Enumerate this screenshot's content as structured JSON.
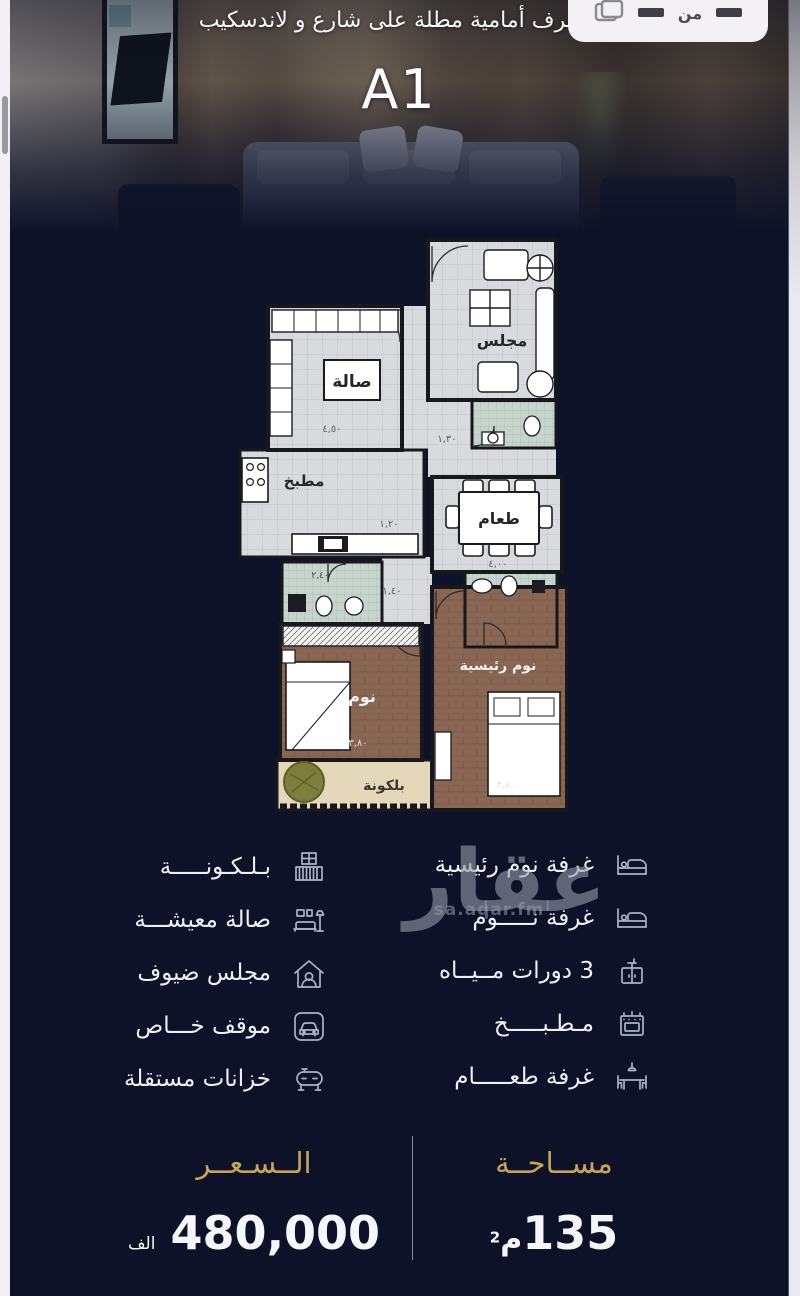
{
  "hero": {
    "title": "4 غرف أمامية مطلة على شارع و لاندسكيب",
    "unit_label": "A1",
    "badge_text": "من"
  },
  "floor_plan": {
    "rooms": {
      "majlis": "مجلس",
      "hall": "صالة",
      "kitchen": "مطبخ",
      "dining": "طعام",
      "bedroom": "نوم",
      "master_bedroom": "نوم رئيسية",
      "balcony": "بلكونة"
    },
    "dims": {
      "hall": "٤,٥٠",
      "dining": "٤,٠٠",
      "bedroom": "٣,٨٠",
      "master_bedroom": "٣,٨٠",
      "corridor_top": "١,٣٠",
      "corridor_kitchen": "١,٢٠",
      "corridor_lower": "١,٤٠",
      "bathroom": "٢,٤٠"
    }
  },
  "features": {
    "right": [
      {
        "icon": "bed-icon",
        "label": "غرفة نوم رئيسية"
      },
      {
        "icon": "bed-icon",
        "label": "غرفة نـــــوم"
      },
      {
        "icon": "sink-icon",
        "label": "3 دورات مــيــاه"
      },
      {
        "icon": "oven-icon",
        "label": "مـطـبـــــخ"
      },
      {
        "icon": "dining-table-icon",
        "label": "غرفة طعـــــام"
      }
    ],
    "left": [
      {
        "icon": "balcony-icon",
        "label": "بـلـكـونـــــة"
      },
      {
        "icon": "living-room-icon",
        "label": "صالة معيشـــة"
      },
      {
        "icon": "guest-majlis-icon",
        "label": "مجلس ضيوف"
      },
      {
        "icon": "car-icon",
        "label": "موقف خـــاص"
      },
      {
        "icon": "water-tank-icon",
        "label": "خزانات مستقلة"
      }
    ]
  },
  "watermark": {
    "brand": "عقار",
    "site": "sa.aqar.fm"
  },
  "summary": {
    "price": {
      "heading": "الــسـعــر",
      "value": "480,000",
      "unit": "الف"
    },
    "area": {
      "heading": "مســاحــة",
      "value": "135",
      "unit": "م",
      "sup": "2"
    }
  },
  "colors": {
    "background": "#0e1228",
    "gold": "#c6a45c",
    "text_light": "#eef0f6",
    "icon_stroke": "#a9b2c6",
    "watermark": "#969da8",
    "badge_bg": "#f3f1f3",
    "plan_floor": "#d9dade",
    "plan_bathroom_tile": "#c6d4cc",
    "plan_wood": "#8a6753",
    "plan_balcony": "#e5d8ba"
  }
}
